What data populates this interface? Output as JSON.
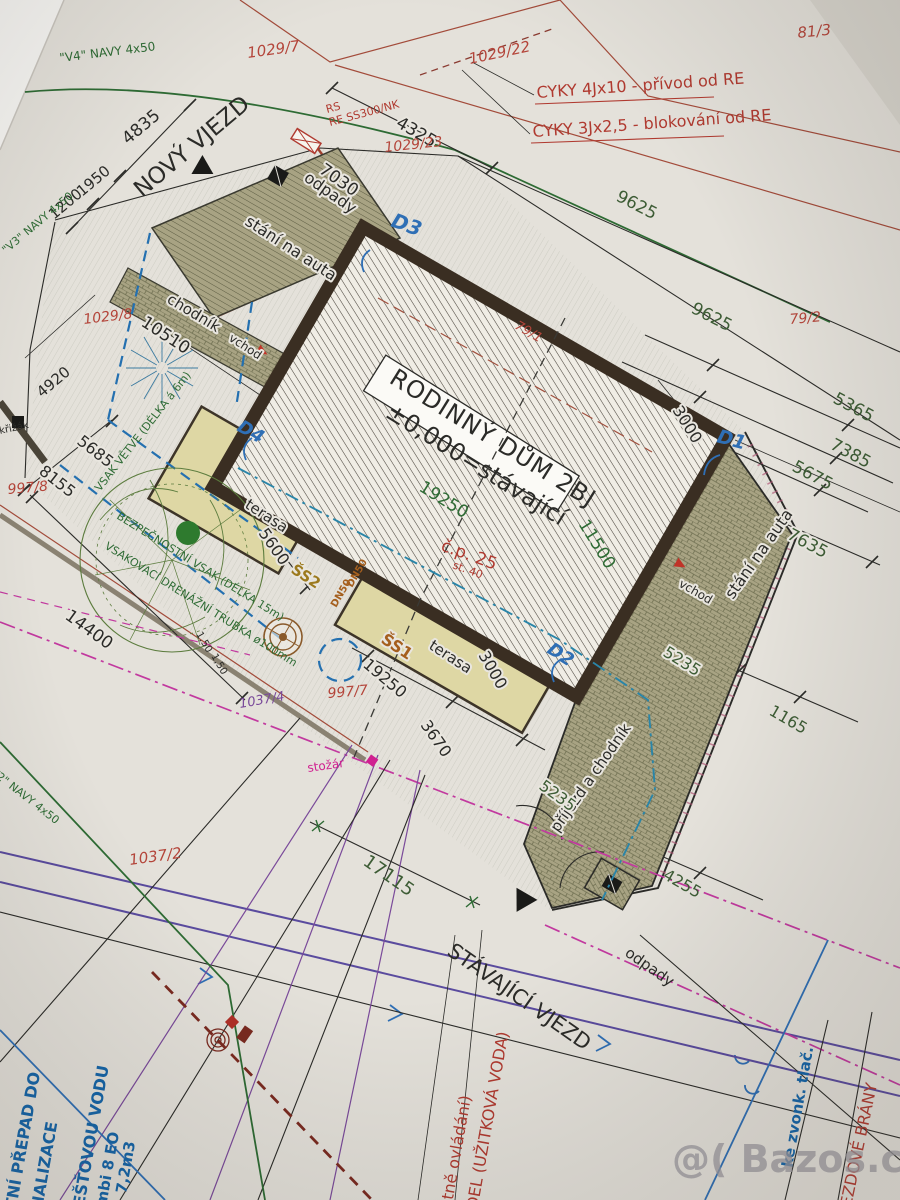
{
  "colors": {
    "paper": "#e4e1da",
    "ink": "#2b2b28",
    "parcel_red": "#b4453a",
    "cable_red": "#b03a30",
    "pipe_green": "#2e6b34",
    "dim_green": "#3d5c35",
    "note_blue": "#1565a8",
    "drain_blue": "#2470b0",
    "magenta": "#c2399f",
    "road_purple": "#5a4b9e",
    "terrace_fill": "#ded7a4",
    "pavement_fill": "#a8a383",
    "house_wall": "#3a2e22",
    "shaft_gold": "#9c7a1e",
    "watermark_gray": "#9c99a0"
  },
  "title": {
    "house_line1": "RODINNÝ DŮM 2BJ",
    "house_line2": "±0,000=stávající",
    "house_number": "č.p. 25",
    "house_st": "st. 40"
  },
  "entrances": {
    "new": "NOVÝ VJEZD",
    "existing": "STÁVAJÍCÍ VJEZD"
  },
  "cables": {
    "cable1": "CYKY 4Jx10 - přívod od RE",
    "cable2": "CYKY 3Jx2,5 - blokování od RE",
    "rs": "RS",
    "re": "RE SS300/NK"
  },
  "parcels": {
    "p81_3": "81/3",
    "p1029_7": "1029/7",
    "p1029_22": "1029/22",
    "p1029_23": "1029/23",
    "p1029_8": "1029/8",
    "p79_1": "79/1",
    "p79_2": "79/2",
    "p997_7": "997/7",
    "p997_8": "997/8",
    "p1037_2": "1037/2",
    "p1037_4": "1037/4"
  },
  "dims": {
    "d4835": "4835",
    "d1950": "1950",
    "d1200": "1200",
    "d4325": "4325",
    "d7030": "7030",
    "d9625a": "9625",
    "d9625b": "9625",
    "d5365": "5365",
    "d7385": "7385",
    "d5675": "5675",
    "d3000a": "3000",
    "d11500": "11500",
    "d19250a": "19250",
    "d19250b": "19250",
    "d3000b": "3000",
    "d3670": "3670",
    "d5600": "5600",
    "d10510": "10510",
    "d4920": "4920",
    "d5685": "5685",
    "d8155": "8155",
    "d14400": "14400",
    "d7635": "7635",
    "d5235a": "5235",
    "d5235b": "5235",
    "d1165": "1165",
    "d4255": "4255",
    "d17115": "17115",
    "d150a": "1,50",
    "d150b": "1,50"
  },
  "areas": {
    "odpady_top": "odpady",
    "odpady_bottom": "odpady",
    "stani_top": "stání na auta",
    "stani_right": "stání na auta",
    "chodnik": "chodník",
    "terasa_top": "terasa",
    "terasa_bottom": "terasa",
    "prijezd": "příjezd a chodník",
    "vchod_left": "vchod",
    "vchod_right": "vchod"
  },
  "markers": {
    "D1": "D1",
    "D2": "D2",
    "D3": "D3",
    "D4": "D4",
    "SS1": "ŠS1",
    "SS2": "ŠS2",
    "krizak": "křižák",
    "stozar": "stožár",
    "dn50a": "DN50",
    "dn50b": "DN50"
  },
  "pipes": {
    "v4": "\"V4\" NAVY 4x50",
    "v3": "\"V3\" NAVY 4x50",
    "v2": "\"V2\" NAVY 4x50"
  },
  "notes_green": {
    "vsak": "VSAK VĚTVE (DÉLKA á 6m)",
    "bezpecnostni": "BEZPEČNOSTNÍ VSAK (DÉLKA 15m)",
    "drenazni": "VSAKOVACÍ DRENÁŽNÍ TRUBKA ø100mm"
  },
  "notes_blue": {
    "prepad1": "TNÍ PŘEPAD DO",
    "prepad2": "NALIZACE",
    "destova": "EŠŤOVOU VODU",
    "kombi": "mbi 8 EO",
    "objem": "7,2m3",
    "zvonek": "ke zvonk. tlač."
  },
  "notes_red": {
    "ovladani": "V (včetně ovládání)",
    "uzitkova": "RPADEL (UŽITKOVÁ VODA)",
    "brany": "JEZDOVÉ BRÁNY"
  },
  "watermark": "@( Bazos.cz"
}
